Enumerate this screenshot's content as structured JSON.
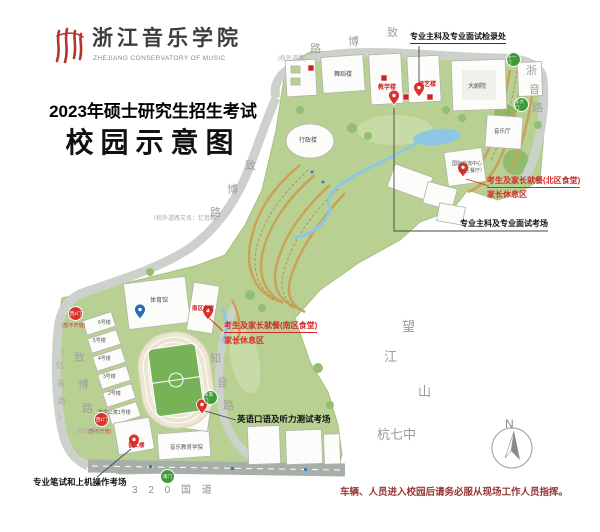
{
  "logo": {
    "name_cn": "浙江音乐学院",
    "name_en": "ZHEJIANG CONSERVATORY OF MUSIC"
  },
  "title": {
    "line1": "2023年硕士研究生招生考试",
    "line2": "校园示意图"
  },
  "callouts": {
    "checkin_label": "专业主科及专业面试检录处",
    "main_exam_label": "专业主科及专业面试考场",
    "north_dining_label": "考生及家长就餐(北区食堂)",
    "north_rest_label": "家长休息区",
    "south_dining_label": "考生及家长就餐(南区食堂)",
    "south_rest_label": "家长休息区",
    "english_exam_label": "英语口语及听力测试考场",
    "written_exam_label": "专业笔试和上机操作考场",
    "notice": "车辆、人员进入校园后请务必服从现场工作人员指挥。"
  },
  "buildings": {
    "wudao": "舞蹈楼",
    "jiaoxue": "教学楼",
    "zongyi": "综艺楼",
    "dajuyuan": "大剧院",
    "yinyueting": "音乐厅",
    "xingzheng": "行政楼",
    "guoji_1": "国际交流中心",
    "guoji_2": "（北区餐厅）",
    "tiyuguan": "体育馆",
    "nanqu": "南区食堂",
    "yingong": "音工楼",
    "yinjiao": "音乐教育学院",
    "dorm6": "6号楼",
    "dorm5": "5号楼",
    "dorm4": "4号楼",
    "dorm3": "3号楼",
    "dorm2": "2号楼",
    "dorm1": "学生公寓1号楼"
  },
  "gates": {
    "dongyi": "东一门",
    "dongda": "东大门",
    "dongnan": "东南门",
    "nan": "南门",
    "xi2": "西2门",
    "xi1": "西1门",
    "closed": "(暂不开放)"
  },
  "roads": {
    "zheyin": [
      "浙",
      "音",
      "路"
    ],
    "zhibo_top": [
      "致",
      "博",
      "路"
    ],
    "zhibo_mid": [
      "致",
      "博",
      "路"
    ],
    "zhibo_bottom": [
      "致",
      "博",
      "路"
    ],
    "yiyin_bottom": [
      "（",
      "忆",
      "音",
      "路",
      "）"
    ],
    "zhiyin": [
      "知",
      "音",
      "路"
    ],
    "g320": "3 2 0 国 道",
    "offcampus_top": "(校外道路)",
    "offcampus_left": "(校外道路)",
    "offcampus_alias": "（校外道路又名：忆音路）"
  },
  "landmarks": {
    "wangjiangshan": [
      "望",
      "江",
      "山"
    ],
    "hangqizhong": "杭七中"
  },
  "compass": {
    "label": "N"
  },
  "colors": {
    "campus_green": "#b9d093",
    "road_gray": "#cdd1cc",
    "marker_red": "#d6342c",
    "gate_green": "#3f9c35",
    "notice_red": "#943634"
  }
}
